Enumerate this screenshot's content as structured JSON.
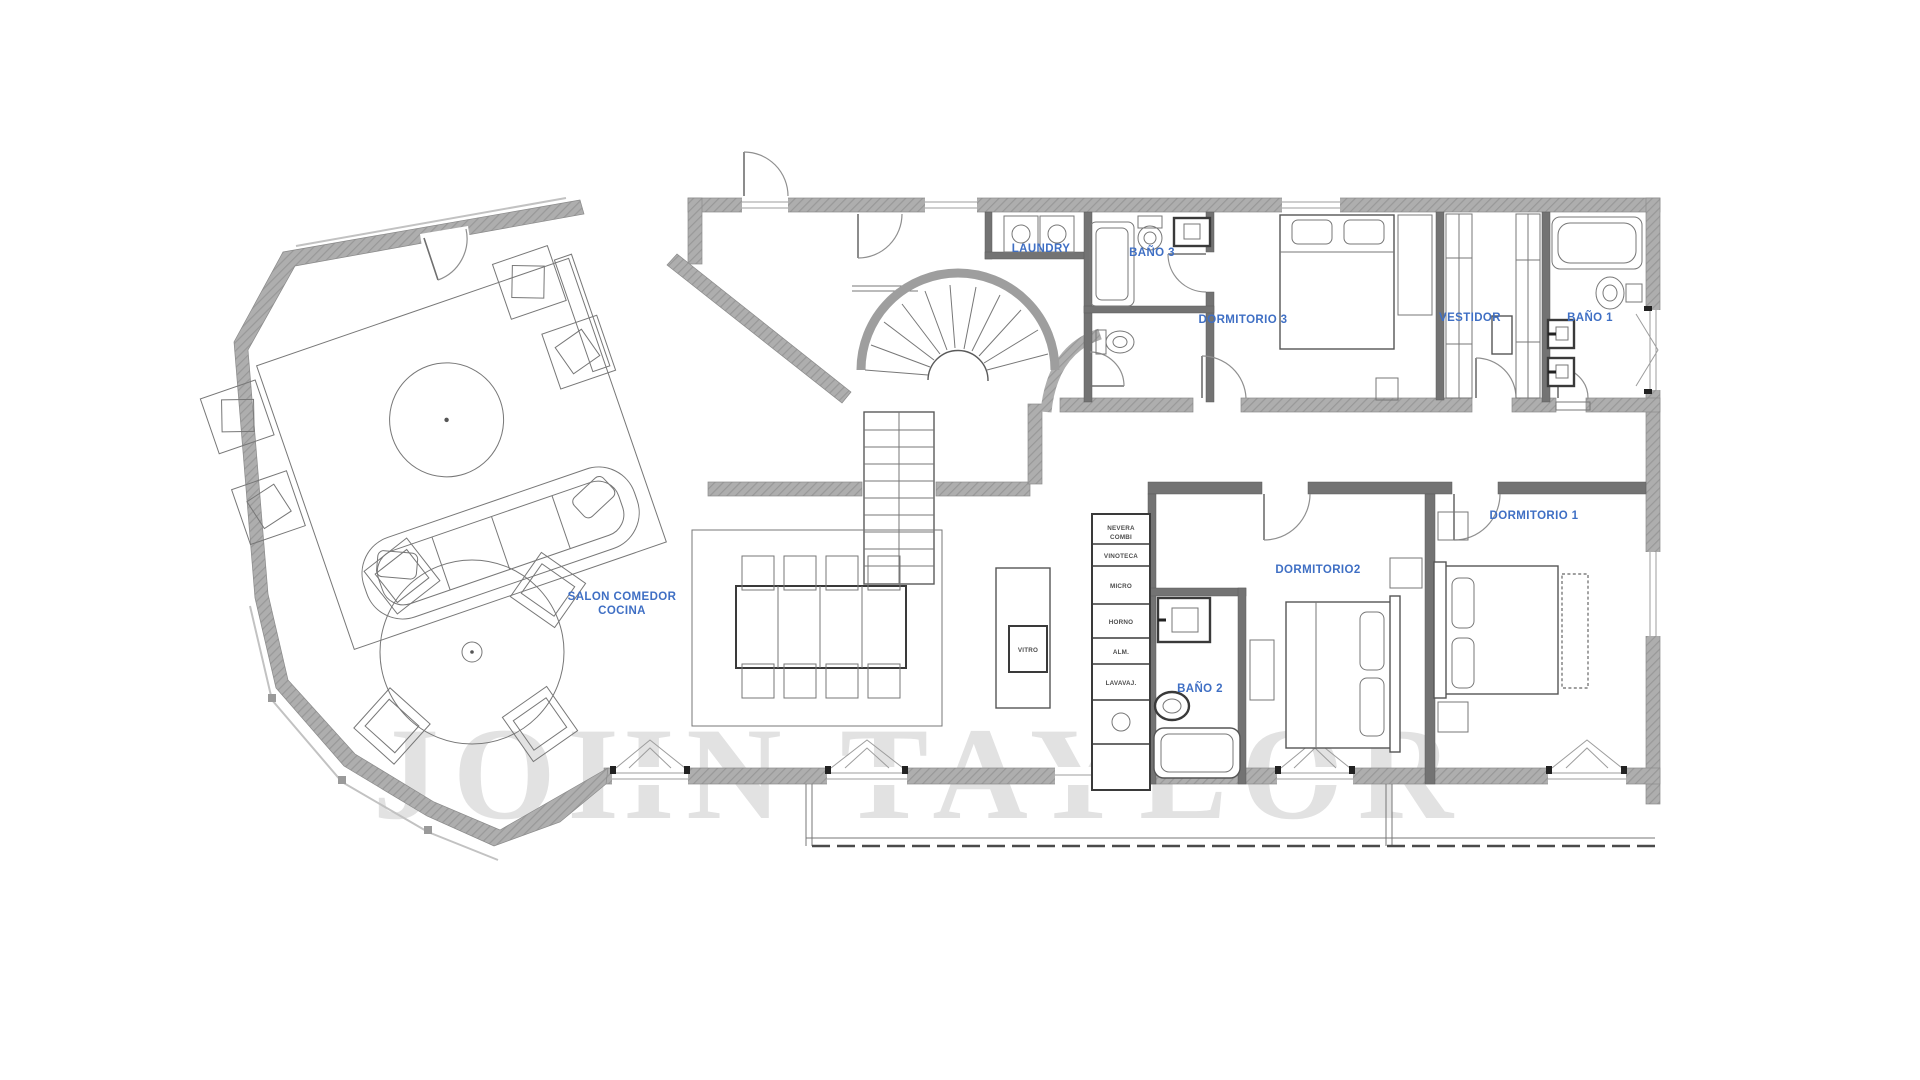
{
  "plan": {
    "title": "apartment-floor-plan",
    "label_color": "#3f6fc4",
    "small_label_color": "#4d4d4d",
    "wall_color": "#aeaeae",
    "watermark": {
      "text": "JOHN TAYLOR",
      "color": "#e2e2e2"
    },
    "rooms": {
      "salon": {
        "line1": "SALON COMEDOR",
        "line2": "COCINA"
      },
      "laundry": {
        "label": "LAUNDRY"
      },
      "bano3": {
        "label": "BAÑO 3"
      },
      "dormitorio3": {
        "label": "DORMITORIO 3"
      },
      "vestidor": {
        "label": "VESTIDOR"
      },
      "bano1": {
        "label": "BAÑO 1"
      },
      "dormitorio1": {
        "label": "DORMITORIO 1"
      },
      "dormitorio2": {
        "label": "DORMITORIO2"
      },
      "bano2": {
        "label": "BAÑO 2"
      }
    },
    "kitchen": {
      "island_label": "VITRO",
      "appliances": [
        {
          "l1": "NEVERA",
          "l2": "COMBI"
        },
        {
          "l1": "VINOTECA"
        },
        {
          "l1": "MICRO"
        },
        {
          "l1": "HORNO"
        },
        {
          "l1": "ALM."
        },
        {
          "l1": "LAVAVAJ."
        }
      ]
    }
  }
}
